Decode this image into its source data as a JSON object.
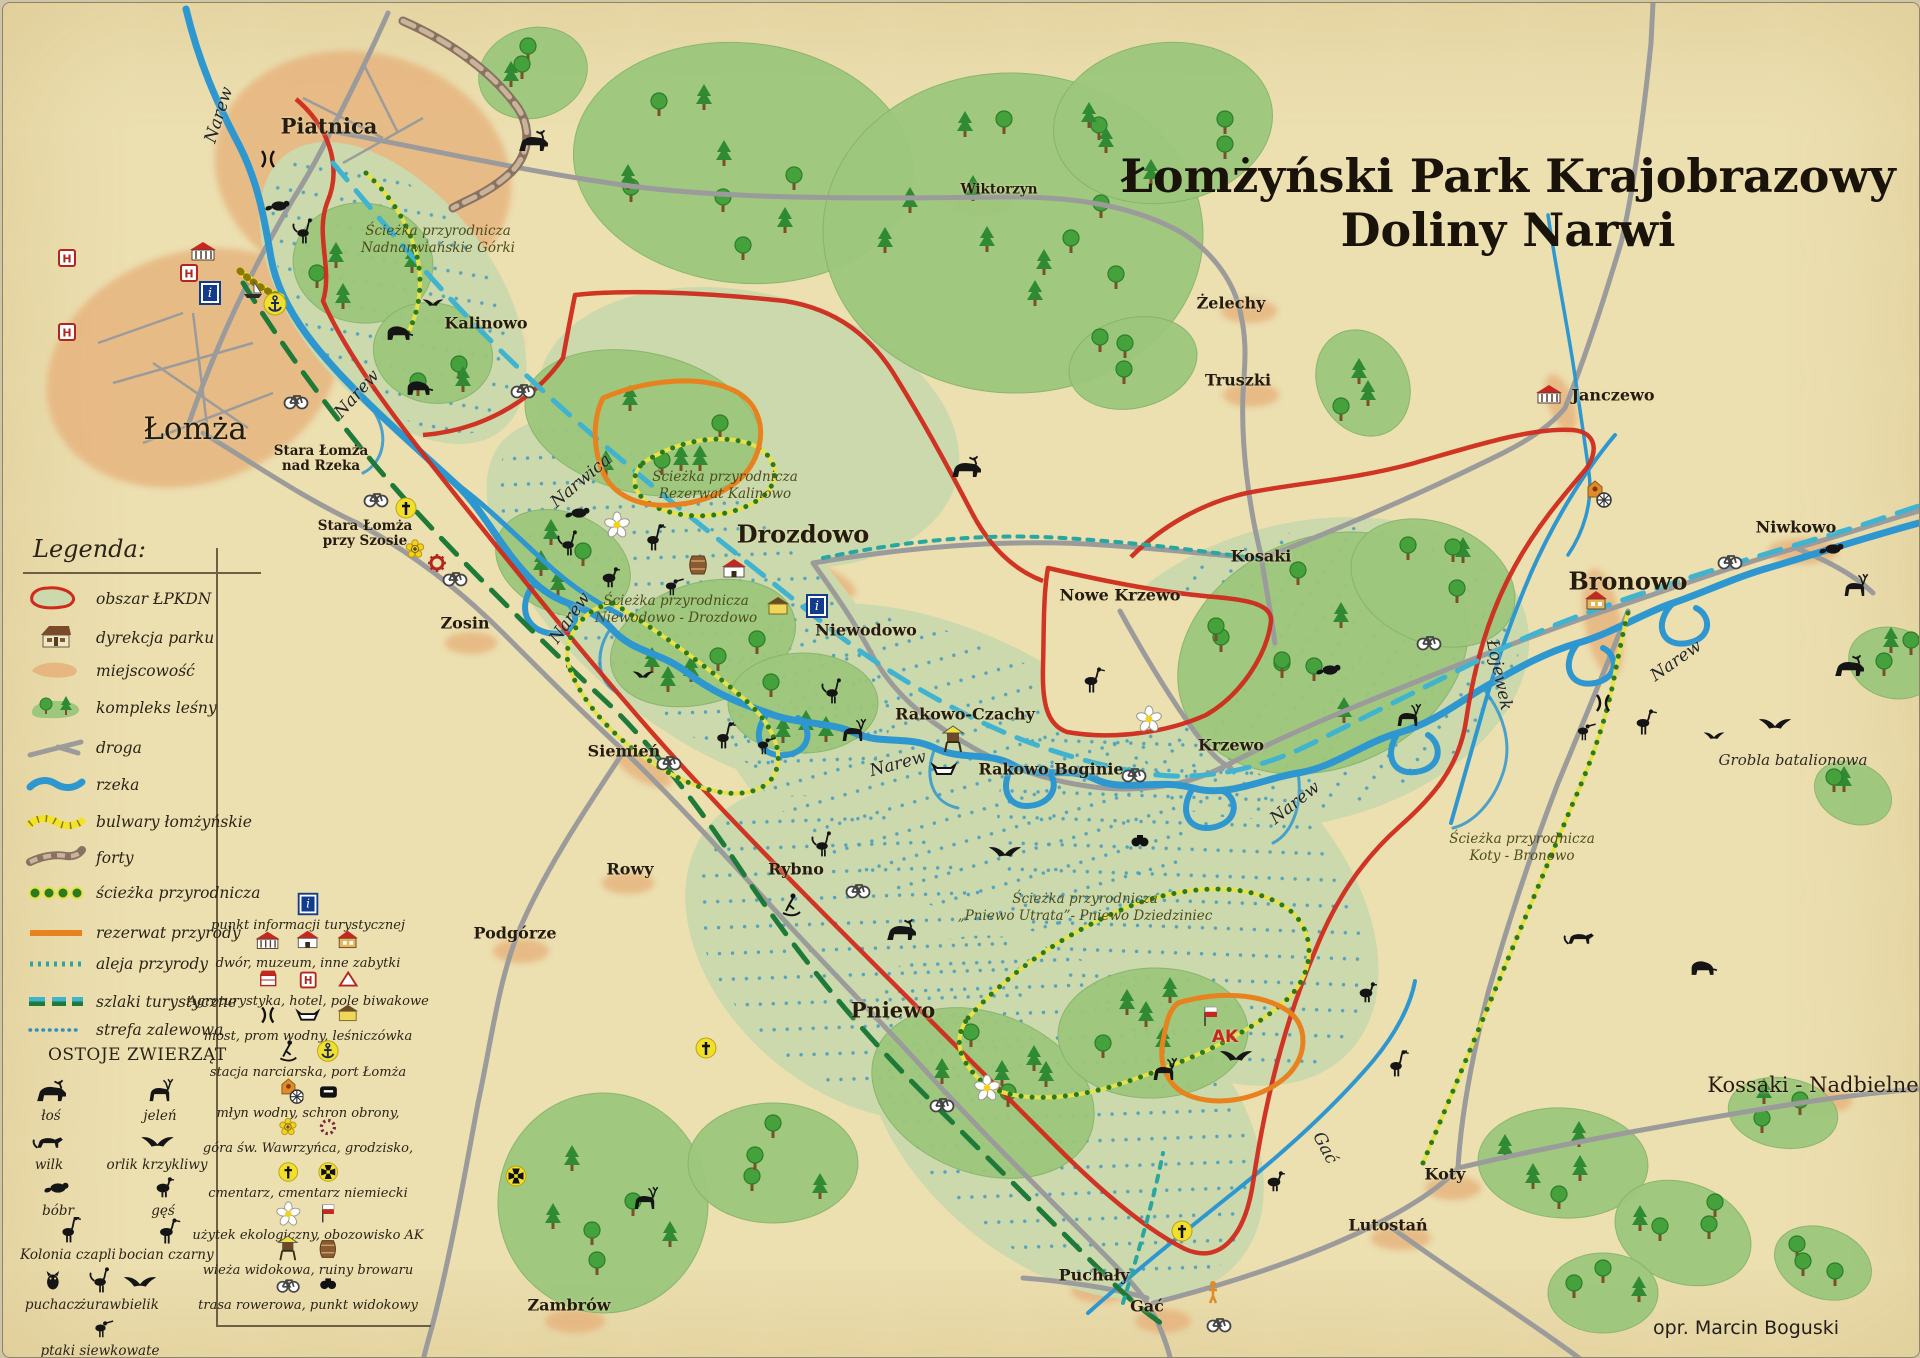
{
  "title": {
    "line1": "Łomżyński Park Krajobrazowy",
    "line2": "Doliny Narwi"
  },
  "attribution": "opr. Marcin Boguski",
  "colors": {
    "parchment": "#ecdfb0",
    "park_band": "#cbd9ad",
    "forest": "#9cc77c",
    "river": "#2f97cf",
    "road": "#9b9b9b",
    "boundary_red": "#cf2b1c",
    "reserve_orange": "#e8821e",
    "trail_dot_green": "#2c7a1e",
    "trail_yellow": "#e8e24a",
    "route_cyan": "#3fb3cf",
    "route_green": "#1e7a38",
    "avenue_teal": "#2aa6a0",
    "flood_blue": "#2f8fc0",
    "town_orange": "#e6b27c",
    "fort_brown": "#8a7263",
    "boulevard_yellow": "#f2e32a"
  },
  "legend": {
    "header": "Legenda:",
    "items": [
      {
        "symbol": "area",
        "label": "obszar  ŁPKDN"
      },
      {
        "symbol": "house",
        "label": "dyrekcja parku"
      },
      {
        "symbol": "town",
        "label": "miejscowość"
      },
      {
        "symbol": "forest",
        "label": "kompleks leśny"
      },
      {
        "symbol": "road",
        "label": "droga"
      },
      {
        "symbol": "river",
        "label": "rzeka"
      },
      {
        "symbol": "boulevard",
        "label": "bulwary łomżyńskie"
      },
      {
        "symbol": "forts",
        "label": "forty"
      },
      {
        "symbol": "naturepath",
        "label": "ścieżka przyrodnicza"
      },
      {
        "symbol": "reserve",
        "label": "rezerwat przyrody"
      },
      {
        "symbol": "avenue",
        "label": "aleja przyrody"
      },
      {
        "symbol": "routes",
        "label": "szlaki turystyczne"
      },
      {
        "symbol": "floodzone",
        "label": "strefa zalewowa"
      }
    ],
    "animals_header": "OSTOJE ZWIERZĄT",
    "animals": [
      {
        "type": "moose",
        "label": "łoś"
      },
      {
        "type": "deer",
        "label": "jeleń"
      },
      {
        "type": "wolf",
        "label": "wilk"
      },
      {
        "type": "eagle",
        "label": "orlik krzykliwy"
      },
      {
        "type": "beaver",
        "label": "bóbr"
      },
      {
        "type": "goose",
        "label": "gęś"
      },
      {
        "type": "heron",
        "label": "Kolonia czapli"
      },
      {
        "type": "stork",
        "label": "bocian czarny"
      },
      {
        "type": "owl",
        "label": "puchacz"
      },
      {
        "type": "crane",
        "label": "żuraw"
      },
      {
        "type": "eagle",
        "label": "bielik"
      },
      {
        "type": "wader",
        "label": "ptaki siewkowate"
      }
    ],
    "facilities": [
      {
        "icons": [
          "info"
        ],
        "label": "punkt informacji turystycznej"
      },
      {
        "icons": [
          "museum",
          "manor",
          "house"
        ],
        "label": "dwór, muzeum, inne zabytki"
      },
      {
        "icons": [
          "agro",
          "hotel",
          "tent"
        ],
        "label": "Agroturystyka, hotel, pole biwakowe"
      },
      {
        "icons": [
          "bridge",
          "ferry",
          "lodge"
        ],
        "label": "most, prom wodny, leśniczówka"
      },
      {
        "icons": [
          "ski",
          "anchor"
        ],
        "label": "stacja narciarska, port Łomża"
      },
      {
        "icons": [
          "mill",
          "shelter"
        ],
        "label": "młyn wodny, schron obrony,"
      },
      {
        "icons": [
          "goldflower",
          "ring"
        ],
        "label": "góra św. Wawrzyńca, grodzisko,"
      },
      {
        "icons": [
          "cross",
          "ironcross"
        ],
        "label": "cmentarz, cmentarz niemiecki"
      },
      {
        "icons": [
          "flower",
          "flag"
        ],
        "label": "użytek ekologiczny, obozowisko AK"
      },
      {
        "icons": [
          "tower",
          "barrel"
        ],
        "label": "wieża widokowa, ruiny browaru"
      },
      {
        "icons": [
          "bike",
          "binoculars"
        ],
        "label": "trasa rowerowa, punkt widokowy"
      }
    ]
  },
  "map": {
    "towns": [
      {
        "n": "Piatnica",
        "x": 326,
        "y": 123,
        "c": "town-lg"
      },
      {
        "n": "Łomża",
        "x": 192,
        "y": 426,
        "c": "city"
      },
      {
        "n": "Stara Łomża|nad Rzeka",
        "x": 318,
        "y": 456,
        "c": "town-sm"
      },
      {
        "n": "Stara Łomża|przy Szosie",
        "x": 362,
        "y": 531,
        "c": "town-sm"
      },
      {
        "n": "Kalinowo",
        "x": 483,
        "y": 320,
        "c": "town"
      },
      {
        "n": "Zosin",
        "x": 462,
        "y": 620,
        "c": "town"
      },
      {
        "n": "Siemień",
        "x": 621,
        "y": 748,
        "c": "town"
      },
      {
        "n": "Rowy",
        "x": 627,
        "y": 866,
        "c": "town"
      },
      {
        "n": "Rybno",
        "x": 793,
        "y": 866,
        "c": "town"
      },
      {
        "n": "Podgórze",
        "x": 512,
        "y": 930,
        "c": "town"
      },
      {
        "n": "Pniewo",
        "x": 890,
        "y": 1007,
        "c": "town-lg"
      },
      {
        "n": "Drozdowo",
        "x": 800,
        "y": 531,
        "c": "town-xl"
      },
      {
        "n": "Niewodowo",
        "x": 863,
        "y": 627,
        "c": "town"
      },
      {
        "n": "Rakowo-Czachy",
        "x": 962,
        "y": 711,
        "c": "town"
      },
      {
        "n": "Rakowo Boginie",
        "x": 1048,
        "y": 766,
        "c": "town"
      },
      {
        "n": "Nowe Krzewo",
        "x": 1117,
        "y": 592,
        "c": "town"
      },
      {
        "n": "Krzewo",
        "x": 1228,
        "y": 742,
        "c": "town"
      },
      {
        "n": "Kosaki",
        "x": 1258,
        "y": 553,
        "c": "town"
      },
      {
        "n": "Wiktorzyn",
        "x": 996,
        "y": 187,
        "c": "town-sm"
      },
      {
        "n": "Żelechy",
        "x": 1228,
        "y": 300,
        "c": "town"
      },
      {
        "n": "Truszki",
        "x": 1235,
        "y": 377,
        "c": "town"
      },
      {
        "n": "Janczewo",
        "x": 1610,
        "y": 392,
        "c": "town"
      },
      {
        "n": "Bronowo",
        "x": 1625,
        "y": 578,
        "c": "town-xl"
      },
      {
        "n": "Niwkowo",
        "x": 1793,
        "y": 524,
        "c": "town"
      },
      {
        "n": "Koty",
        "x": 1442,
        "y": 1171,
        "c": "town"
      },
      {
        "n": "Lutostań",
        "x": 1385,
        "y": 1222,
        "c": "town"
      },
      {
        "n": "Puchały",
        "x": 1091,
        "y": 1272,
        "c": "town"
      },
      {
        "n": "Gać",
        "x": 1144,
        "y": 1303,
        "c": "town"
      },
      {
        "n": "Zambrów",
        "x": 566,
        "y": 1302,
        "c": "town"
      },
      {
        "n": "Kossaki - Nadbielne",
        "x": 1810,
        "y": 1082,
        "c": "region"
      }
    ],
    "rivers": [
      {
        "n": "Narew",
        "x": 216,
        "y": 112,
        "r": -72
      },
      {
        "n": "Narew",
        "x": 354,
        "y": 391,
        "r": -48
      },
      {
        "n": "Narew",
        "x": 567,
        "y": 615,
        "r": -55
      },
      {
        "n": "Narew",
        "x": 895,
        "y": 761,
        "r": -15
      },
      {
        "n": "Narew",
        "x": 1292,
        "y": 800,
        "r": -38
      },
      {
        "n": "Narew",
        "x": 1673,
        "y": 658,
        "r": -35
      },
      {
        "n": "Narwica",
        "x": 578,
        "y": 478,
        "r": -40
      },
      {
        "n": "Łojewek",
        "x": 1496,
        "y": 672,
        "r": 78
      },
      {
        "n": "Gać",
        "x": 1322,
        "y": 1145,
        "r": 62
      }
    ],
    "trails": [
      {
        "l1": "Ścieżka przyrodnicza",
        "l2": "Nadnarwiańskie Górki",
        "x": 435,
        "y": 220
      },
      {
        "l1": "Ścieżka przyrodnicza",
        "l2": "Rezerwat Kalinowo",
        "x": 722,
        "y": 466
      },
      {
        "l1": "Ścieżka przyrodnicza",
        "l2": "Niewodowo - Drozdowo",
        "x": 673,
        "y": 590
      },
      {
        "l1": "Ścieżka przyrodnicza",
        "l2": "„Pniewo Utrata”- Pniewo Dziedziniec",
        "x": 1082,
        "y": 888
      },
      {
        "l1": "Ścieżka przyrodnicza",
        "l2": "Koty - Bronowo",
        "x": 1519,
        "y": 828
      }
    ],
    "notes": [
      {
        "text": "Grobla batalionowa",
        "x": 1790,
        "y": 757
      }
    ],
    "ak_label": {
      "text": "AK",
      "x": 1222,
      "y": 1034
    },
    "icons": [
      {
        "t": "info",
        "x": 207,
        "y": 290
      },
      {
        "t": "info",
        "x": 814,
        "y": 603
      },
      {
        "t": "hotel",
        "x": 64,
        "y": 255
      },
      {
        "t": "hotel",
        "x": 64,
        "y": 329
      },
      {
        "t": "hotel",
        "x": 186,
        "y": 270
      },
      {
        "t": "museum",
        "x": 200,
        "y": 250
      },
      {
        "t": "anchor",
        "x": 272,
        "y": 301
      },
      {
        "t": "boat",
        "x": 250,
        "y": 288
      },
      {
        "t": "ski",
        "x": 788,
        "y": 902
      },
      {
        "t": "gear",
        "x": 434,
        "y": 560
      },
      {
        "t": "goldflower",
        "x": 412,
        "y": 546
      },
      {
        "t": "cross",
        "x": 403,
        "y": 505
      },
      {
        "t": "cross",
        "x": 703,
        "y": 1045
      },
      {
        "t": "cross",
        "x": 1179,
        "y": 1228
      },
      {
        "t": "ironcross",
        "x": 513,
        "y": 1173
      },
      {
        "t": "flower",
        "x": 614,
        "y": 522
      },
      {
        "t": "flower",
        "x": 1146,
        "y": 716
      },
      {
        "t": "flower",
        "x": 984,
        "y": 1085
      },
      {
        "t": "manor",
        "x": 731,
        "y": 568
      },
      {
        "t": "lodge",
        "x": 775,
        "y": 605
      },
      {
        "t": "barrel",
        "x": 695,
        "y": 562
      },
      {
        "t": "tower",
        "x": 950,
        "y": 737
      },
      {
        "t": "ferry",
        "x": 941,
        "y": 766
      },
      {
        "t": "bridge",
        "x": 265,
        "y": 156
      },
      {
        "t": "bridge",
        "x": 1600,
        "y": 700
      },
      {
        "t": "mill",
        "x": 1592,
        "y": 492
      },
      {
        "t": "museum",
        "x": 1546,
        "y": 393
      },
      {
        "t": "house",
        "x": 1593,
        "y": 600
      },
      {
        "t": "flag",
        "x": 1208,
        "y": 1014
      },
      {
        "t": "person",
        "x": 1210,
        "y": 1289
      },
      {
        "t": "binoculars",
        "x": 1137,
        "y": 838
      },
      {
        "t": "bike",
        "x": 293,
        "y": 397
      },
      {
        "t": "bike",
        "x": 373,
        "y": 495
      },
      {
        "t": "bike",
        "x": 452,
        "y": 574
      },
      {
        "t": "bike",
        "x": 520,
        "y": 386
      },
      {
        "t": "bike",
        "x": 666,
        "y": 758
      },
      {
        "t": "bike",
        "x": 855,
        "y": 886
      },
      {
        "t": "bike",
        "x": 939,
        "y": 1100
      },
      {
        "t": "bike",
        "x": 1131,
        "y": 770
      },
      {
        "t": "bike",
        "x": 1426,
        "y": 638
      },
      {
        "t": "bike",
        "x": 1727,
        "y": 557
      },
      {
        "t": "bike",
        "x": 1216,
        "y": 1320
      }
    ],
    "animals": [
      {
        "t": "beaver",
        "x": 276,
        "y": 203
      },
      {
        "t": "crane",
        "x": 300,
        "y": 230
      },
      {
        "t": "boar",
        "x": 395,
        "y": 330
      },
      {
        "t": "bird",
        "x": 430,
        "y": 300
      },
      {
        "t": "boar",
        "x": 415,
        "y": 385
      },
      {
        "t": "beaver",
        "x": 576,
        "y": 510
      },
      {
        "t": "crane",
        "x": 565,
        "y": 542
      },
      {
        "t": "heron",
        "x": 650,
        "y": 537
      },
      {
        "t": "goose",
        "x": 606,
        "y": 575
      },
      {
        "t": "wader",
        "x": 668,
        "y": 583
      },
      {
        "t": "bird",
        "x": 640,
        "y": 672
      },
      {
        "t": "crane",
        "x": 829,
        "y": 690
      },
      {
        "t": "deer",
        "x": 850,
        "y": 730
      },
      {
        "t": "moose",
        "x": 963,
        "y": 466
      },
      {
        "t": "heron",
        "x": 720,
        "y": 735
      },
      {
        "t": "wader",
        "x": 760,
        "y": 742
      },
      {
        "t": "stork",
        "x": 1088,
        "y": 678
      },
      {
        "t": "eagle",
        "x": 1002,
        "y": 849
      },
      {
        "t": "crane",
        "x": 819,
        "y": 843
      },
      {
        "t": "moose",
        "x": 898,
        "y": 929
      },
      {
        "t": "deer",
        "x": 642,
        "y": 1198
      },
      {
        "t": "boar",
        "x": 1699,
        "y": 965
      },
      {
        "t": "wolf",
        "x": 1577,
        "y": 935
      },
      {
        "t": "goose",
        "x": 1363,
        "y": 990
      },
      {
        "t": "stork",
        "x": 1640,
        "y": 720
      },
      {
        "t": "bird",
        "x": 1711,
        "y": 733
      },
      {
        "t": "eagle",
        "x": 1772,
        "y": 721
      },
      {
        "t": "beaver",
        "x": 1830,
        "y": 546
      },
      {
        "t": "deer",
        "x": 1852,
        "y": 585
      },
      {
        "t": "moose",
        "x": 1846,
        "y": 665
      },
      {
        "t": "deer",
        "x": 1161,
        "y": 1069
      },
      {
        "t": "goose",
        "x": 1271,
        "y": 1179
      },
      {
        "t": "heron",
        "x": 1393,
        "y": 1063
      },
      {
        "t": "eagle",
        "x": 1233,
        "y": 1053
      },
      {
        "t": "beaver",
        "x": 1327,
        "y": 667
      },
      {
        "t": "deer",
        "x": 1405,
        "y": 715
      },
      {
        "t": "wader",
        "x": 1580,
        "y": 728
      },
      {
        "t": "moose",
        "x": 530,
        "y": 140
      }
    ]
  }
}
